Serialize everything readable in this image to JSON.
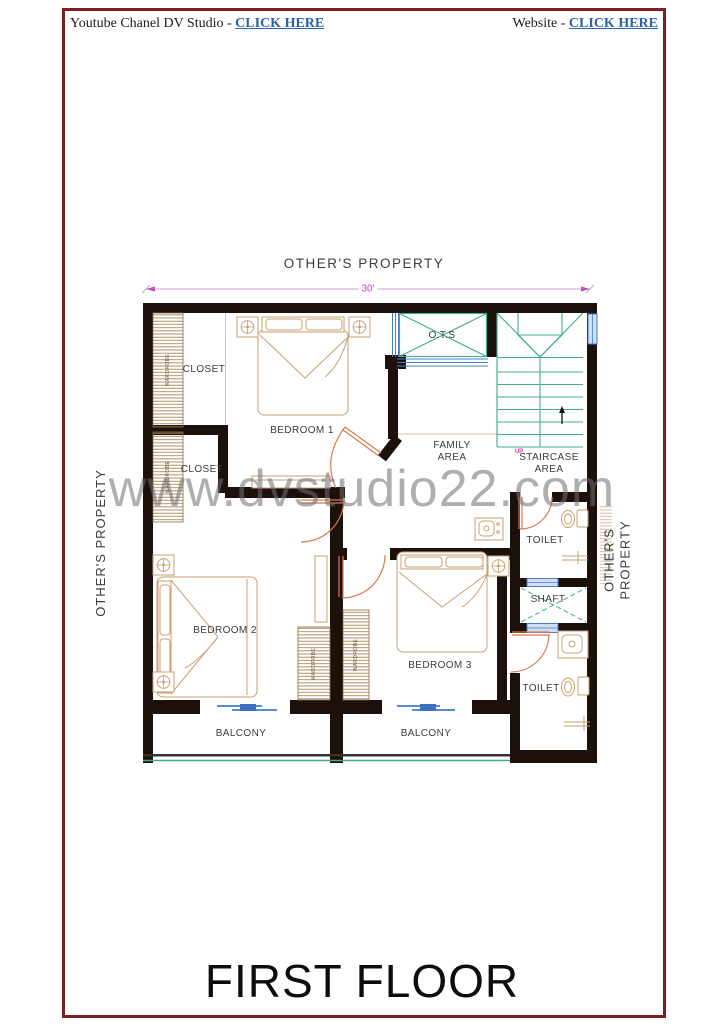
{
  "header": {
    "left_prefix": "Youtube Chanel DV Studio - ",
    "left_link": "CLICK HERE",
    "right_prefix": "Website - ",
    "right_link": "CLICK HERE"
  },
  "watermark": "www.dvstudio22.com",
  "floor_title": "FIRST FLOOR",
  "plan": {
    "dimension_top": "30'",
    "up_label": "UP",
    "surroundings": {
      "top": "OTHER'S PROPERTY",
      "left": "OTHER'S PROPERTY",
      "right": "OTHER'S PROPERTY"
    },
    "rooms": {
      "bedroom1": "BEDROOM 1",
      "bedroom2": "BEDROOM 2",
      "bedroom3": "BEDROOM 3",
      "closet1": "CLOSET",
      "closet2": "CLOSET",
      "family_area": "FAMILY\nAREA",
      "staircase_area": "STAIRCASE\nAREA",
      "ots": "O.T.S",
      "toilet1": "TOILET",
      "toilet2": "TOILET",
      "shaft": "SHAFT",
      "balcony1": "BALCONY",
      "balcony2": "BALCONY"
    },
    "fixtures": {
      "wardrobe1": "WARDROBE",
      "wardrobe2": "WARDROBE",
      "wardrobe3": "WARDROBE",
      "wardrobe4": "WARDROBE"
    }
  },
  "colors": {
    "page_border": "#7b1f1f",
    "link": "#2a63a8",
    "wall": "#1b100a",
    "stair_teal": "#3fae89",
    "window_blue": "#4a7dc9",
    "furniture_tan": "#c9a171",
    "door_swing": "#d9794f",
    "dimension_magenta": "#bb44bb",
    "label_gray": "#3c3c3c",
    "watermark_gray": "#909090"
  }
}
